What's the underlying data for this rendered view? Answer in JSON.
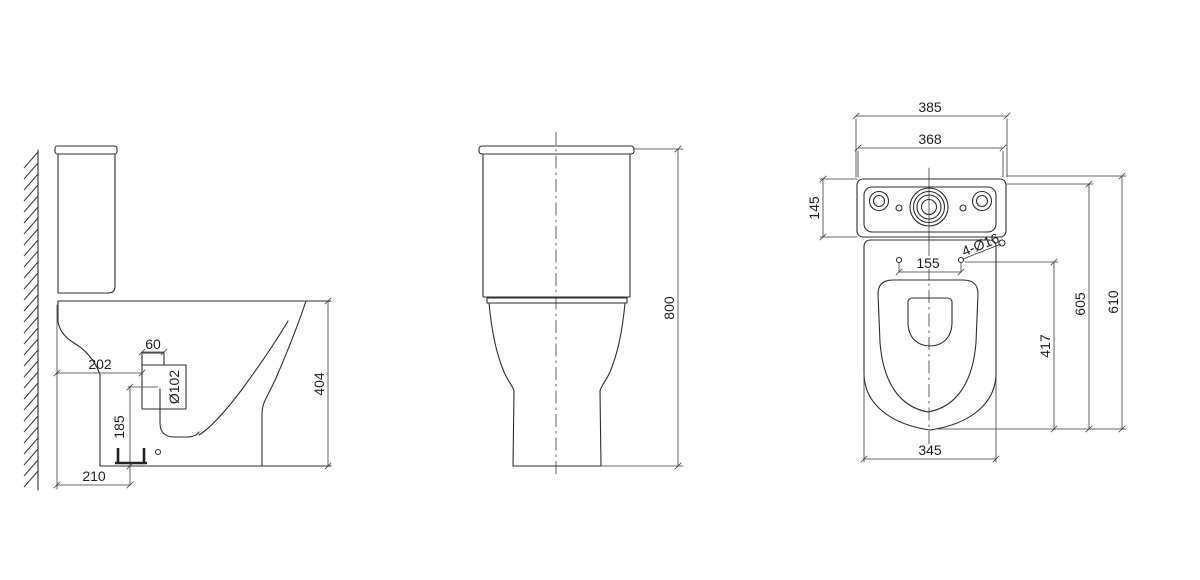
{
  "title": "Close-coupled toilet technical drawing — three orthographic views",
  "colors": {
    "background": "#ffffff",
    "line": "#2e2e2e"
  },
  "views": {
    "side_view": {
      "dimensions": {
        "spigot_width": "60",
        "back_to_outlet": "202",
        "outlet_diameter": "Ø102",
        "outlet_height": "185",
        "back_to_trap": "210",
        "rim_height": "404"
      }
    },
    "front_view": {
      "dimensions": {
        "overall_height": "800"
      }
    },
    "top_view": {
      "dimensions": {
        "cistern_overall_width": "385",
        "cistern_body_width": "368",
        "cistern_depth": "145",
        "fixing_hole_spacing": "155",
        "fixing_holes_note": "4-Ø16",
        "holes_to_front": "417",
        "depth_to_cistern_face": "605",
        "overall_depth": "610",
        "bowl_width": "345"
      }
    }
  }
}
